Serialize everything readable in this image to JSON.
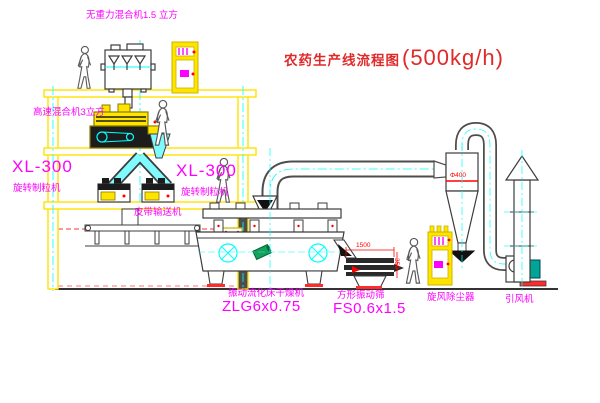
{
  "title": {
    "name": "农药生产线流程图",
    "capacity": "(500kg/h)"
  },
  "labels": {
    "top_mixer": "无重力混合机1.5 立方",
    "high_speed_mixer": "高速混合机3立方",
    "granulator_left_model": "XL-300",
    "granulator_left_name": "旋转制粒机",
    "granulator_right_model": "XL-300",
    "granulator_right_name": "旋转制粒机",
    "belt_conveyor": "皮带输送机",
    "dryer_name": "振动流化床干燥机",
    "dryer_model": "ZLG6x0.75",
    "screen_name": "方形振动筛",
    "screen_model": "FS0.6x1.5",
    "cyclone": "旋风除尘器",
    "fan": "引风机"
  },
  "dimensions": {
    "screen_length": "1500",
    "cyclone_diameter": "Φ400",
    "screen_height": "350"
  },
  "colors": {
    "structure_yellow": "#ffe400",
    "centerline_cyan": "#00ffff",
    "label_magenta": "#ff00ff",
    "title_red": "#e02a2a",
    "dimension_red": "#ff0000",
    "equipment_line": "#3c3c3c",
    "motor_teal": "#00a596",
    "base_red": "#ff2a2a",
    "background": "#ffffff"
  }
}
